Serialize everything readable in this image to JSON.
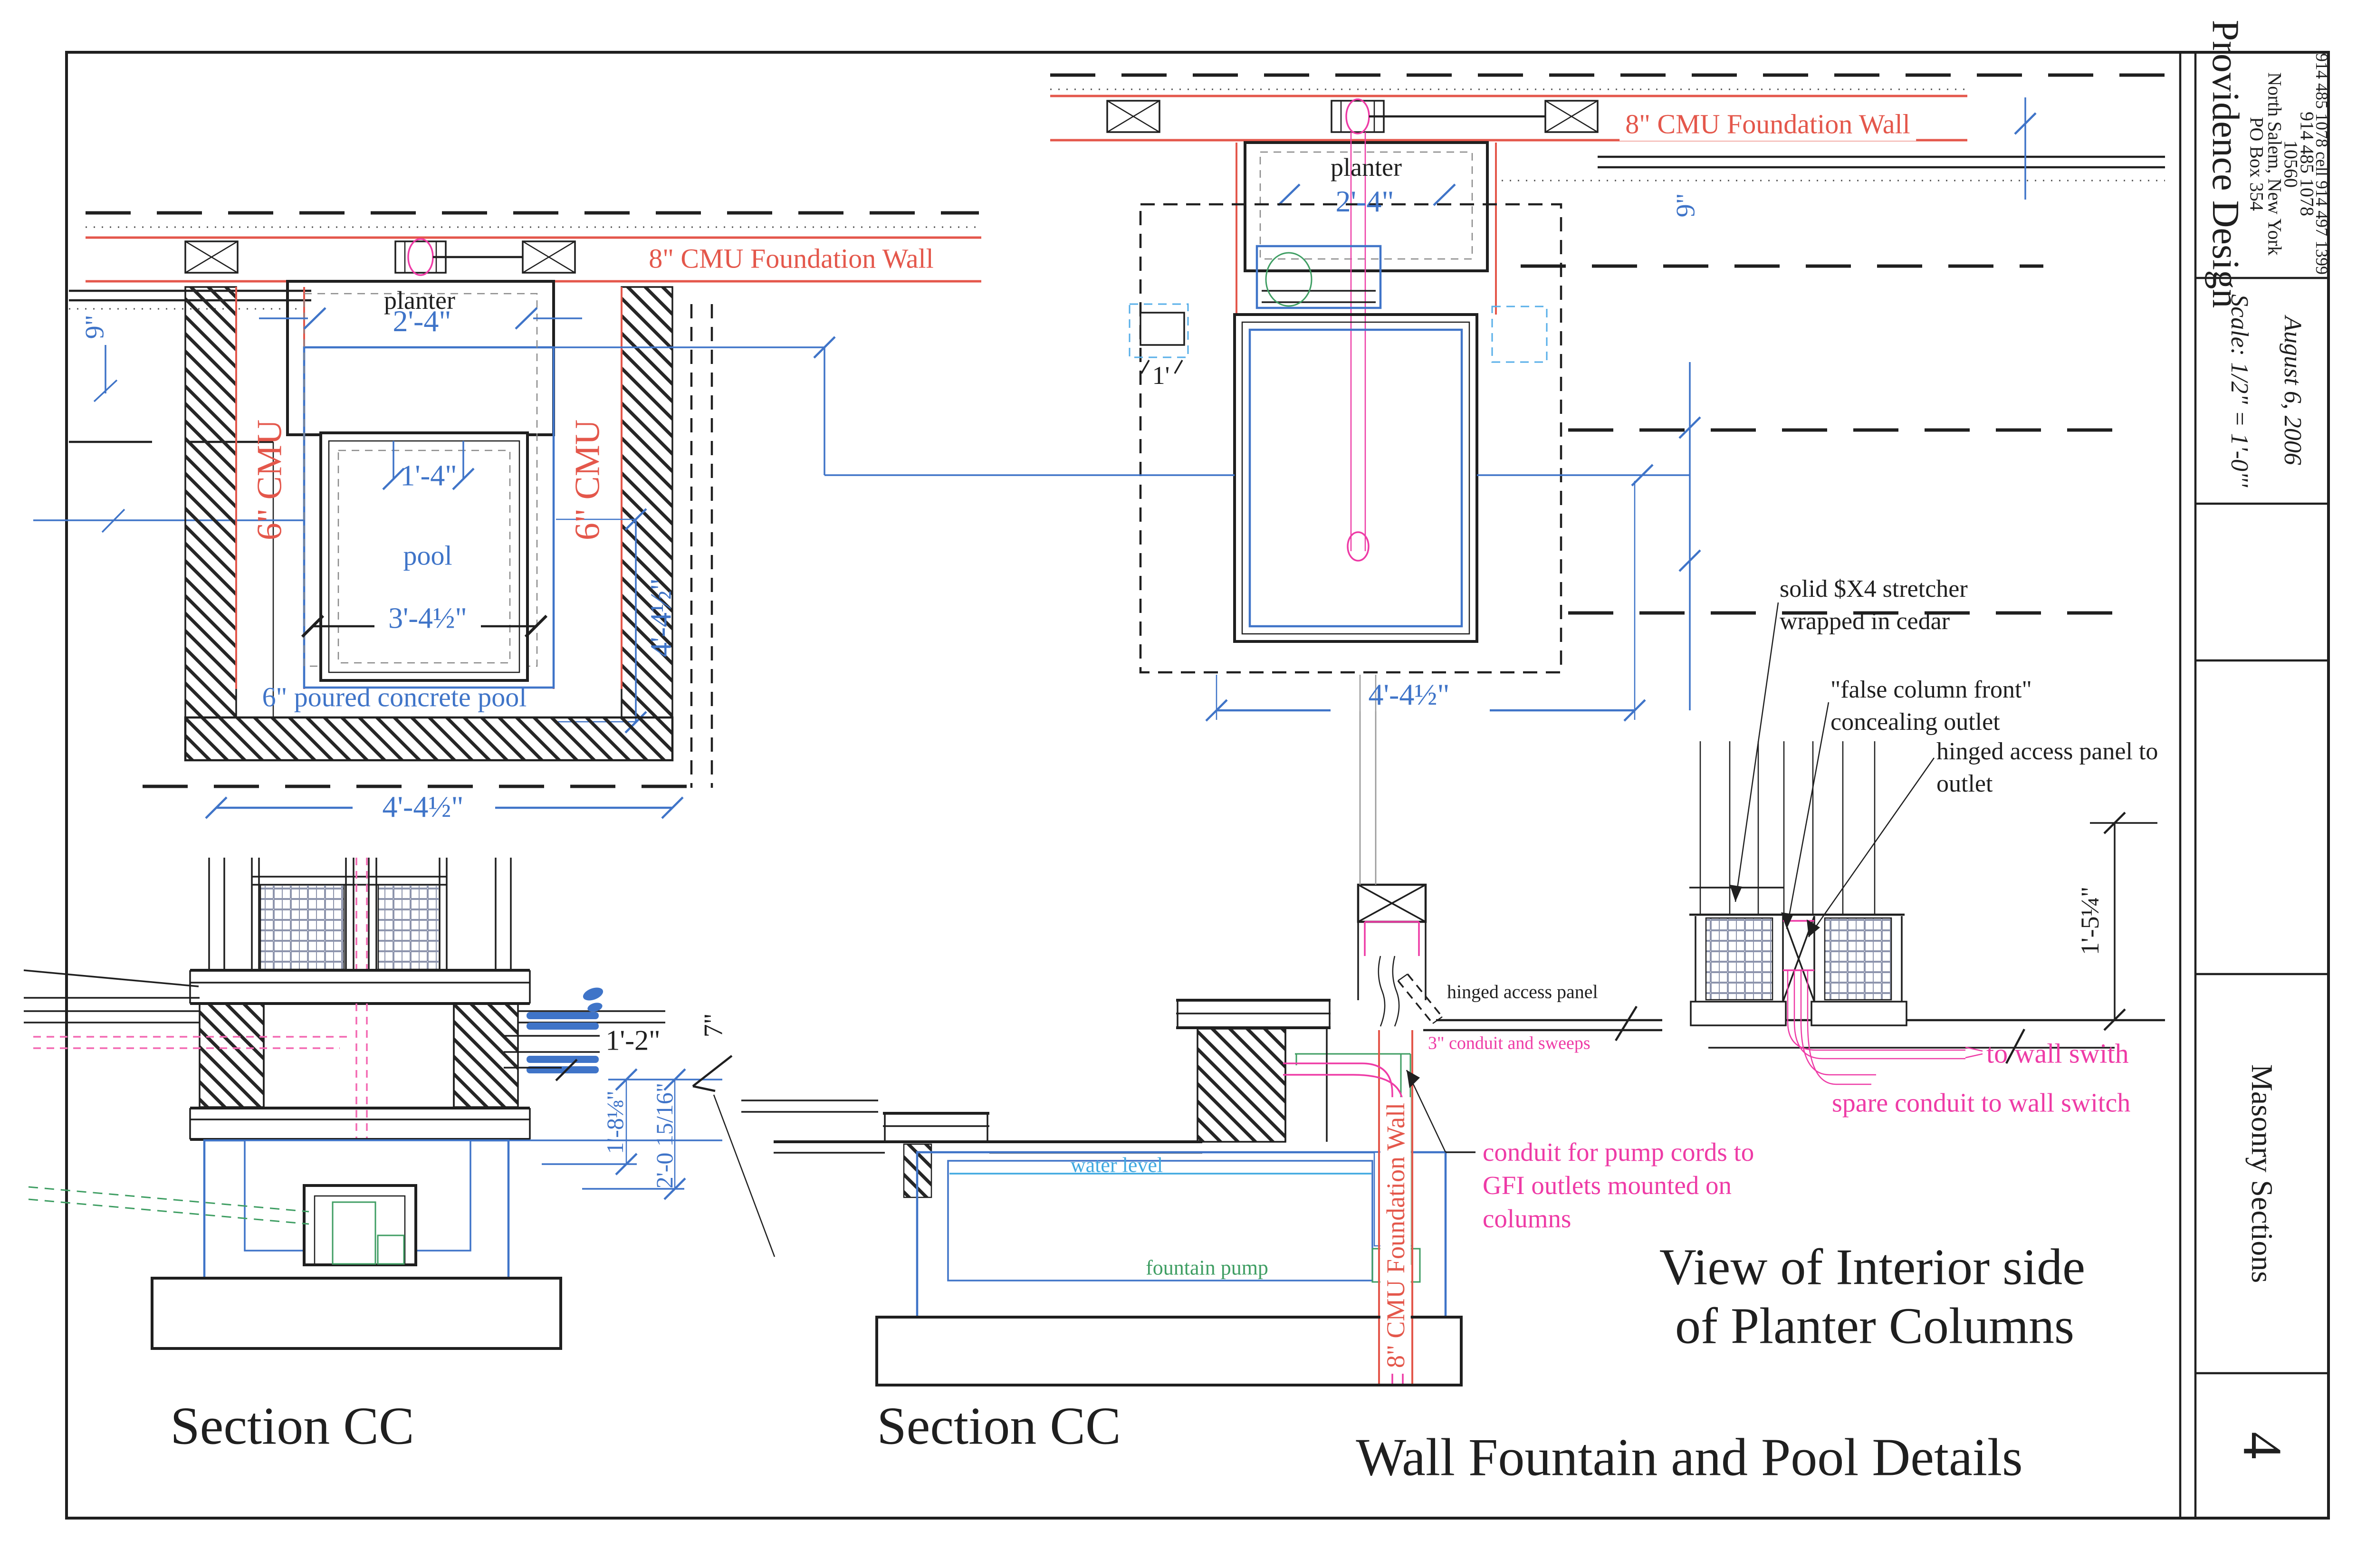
{
  "title_block": {
    "company": "Providence Design",
    "address_line1": "PO Box 354",
    "address_line2": "North Salem, New York",
    "address_line3": "10560",
    "phone1": "914 485 1078",
    "phone2": "914 485 1078  cell  914 497 1399",
    "scale": "Scale: 1/2\" = 1'-0\"'",
    "date": "August 6, 2006",
    "sheet_title": "Masonry Sections",
    "sheet_number": "4"
  },
  "plan_left": {
    "foundation_wall_label": "8\" CMU Foundation Wall",
    "dim_9": "9\"",
    "cmu_left": "6\" CMU",
    "cmu_right": "6\" CMU",
    "planter_label": "planter",
    "dim_2_4": "2'-4\"",
    "dim_1_4": "1'-4\"",
    "pool_label": "pool",
    "dim_3_4_half": "3'-4½\"",
    "poured_label": "6\" poured concrete pool",
    "dim_4_4_half_v": "4'-4½\"",
    "dim_4_4_half_h": "4'-4½\""
  },
  "plan_right": {
    "foundation_wall_label": "8\" CMU Foundation Wall",
    "dim_9": "9\"",
    "planter_label": "planter",
    "dim_2_4": "2'-4\"",
    "dim_1": "1'",
    "dim_4_4_half": "4'-4½\""
  },
  "section_left": {
    "title": "Section CC",
    "dim_1_2": "1'-2\"",
    "dim_7": "7\"",
    "dim_1_8": "1'-8⅛\"",
    "dim_2_0": "2'-0 15/16\""
  },
  "section_mid": {
    "title": "Section CC",
    "water_level": "water level",
    "fountain_pump": "fountain pump",
    "foundation_wall_label": "8\" CMU Foundation Wall",
    "hinged_panel": "hinged access panel",
    "conduit_sweeps": "3\" conduit and sweeps"
  },
  "detail_right": {
    "heading_line1": "View of Interior side",
    "heading_line2": "of Planter Columns",
    "label1_line1": "solid $X4 stretcher",
    "label1_line2": "wrapped in cedar",
    "label2_line1": "\"false column front\"",
    "label2_line2": "concealing outlet",
    "label3_line1": "hinged access panel to",
    "label3_line2": "outlet",
    "dim_1_5_quarter": "1'-5¼\"",
    "to_wall_switch": "to wall swith",
    "spare_conduit": "spare  conduit to wall switch",
    "pump_note_line1": "conduit for pump cords to",
    "pump_note_line2": "GFI outlets mounted on",
    "pump_note_line3": "columns"
  },
  "main_title": "Wall Fountain and Pool Details"
}
